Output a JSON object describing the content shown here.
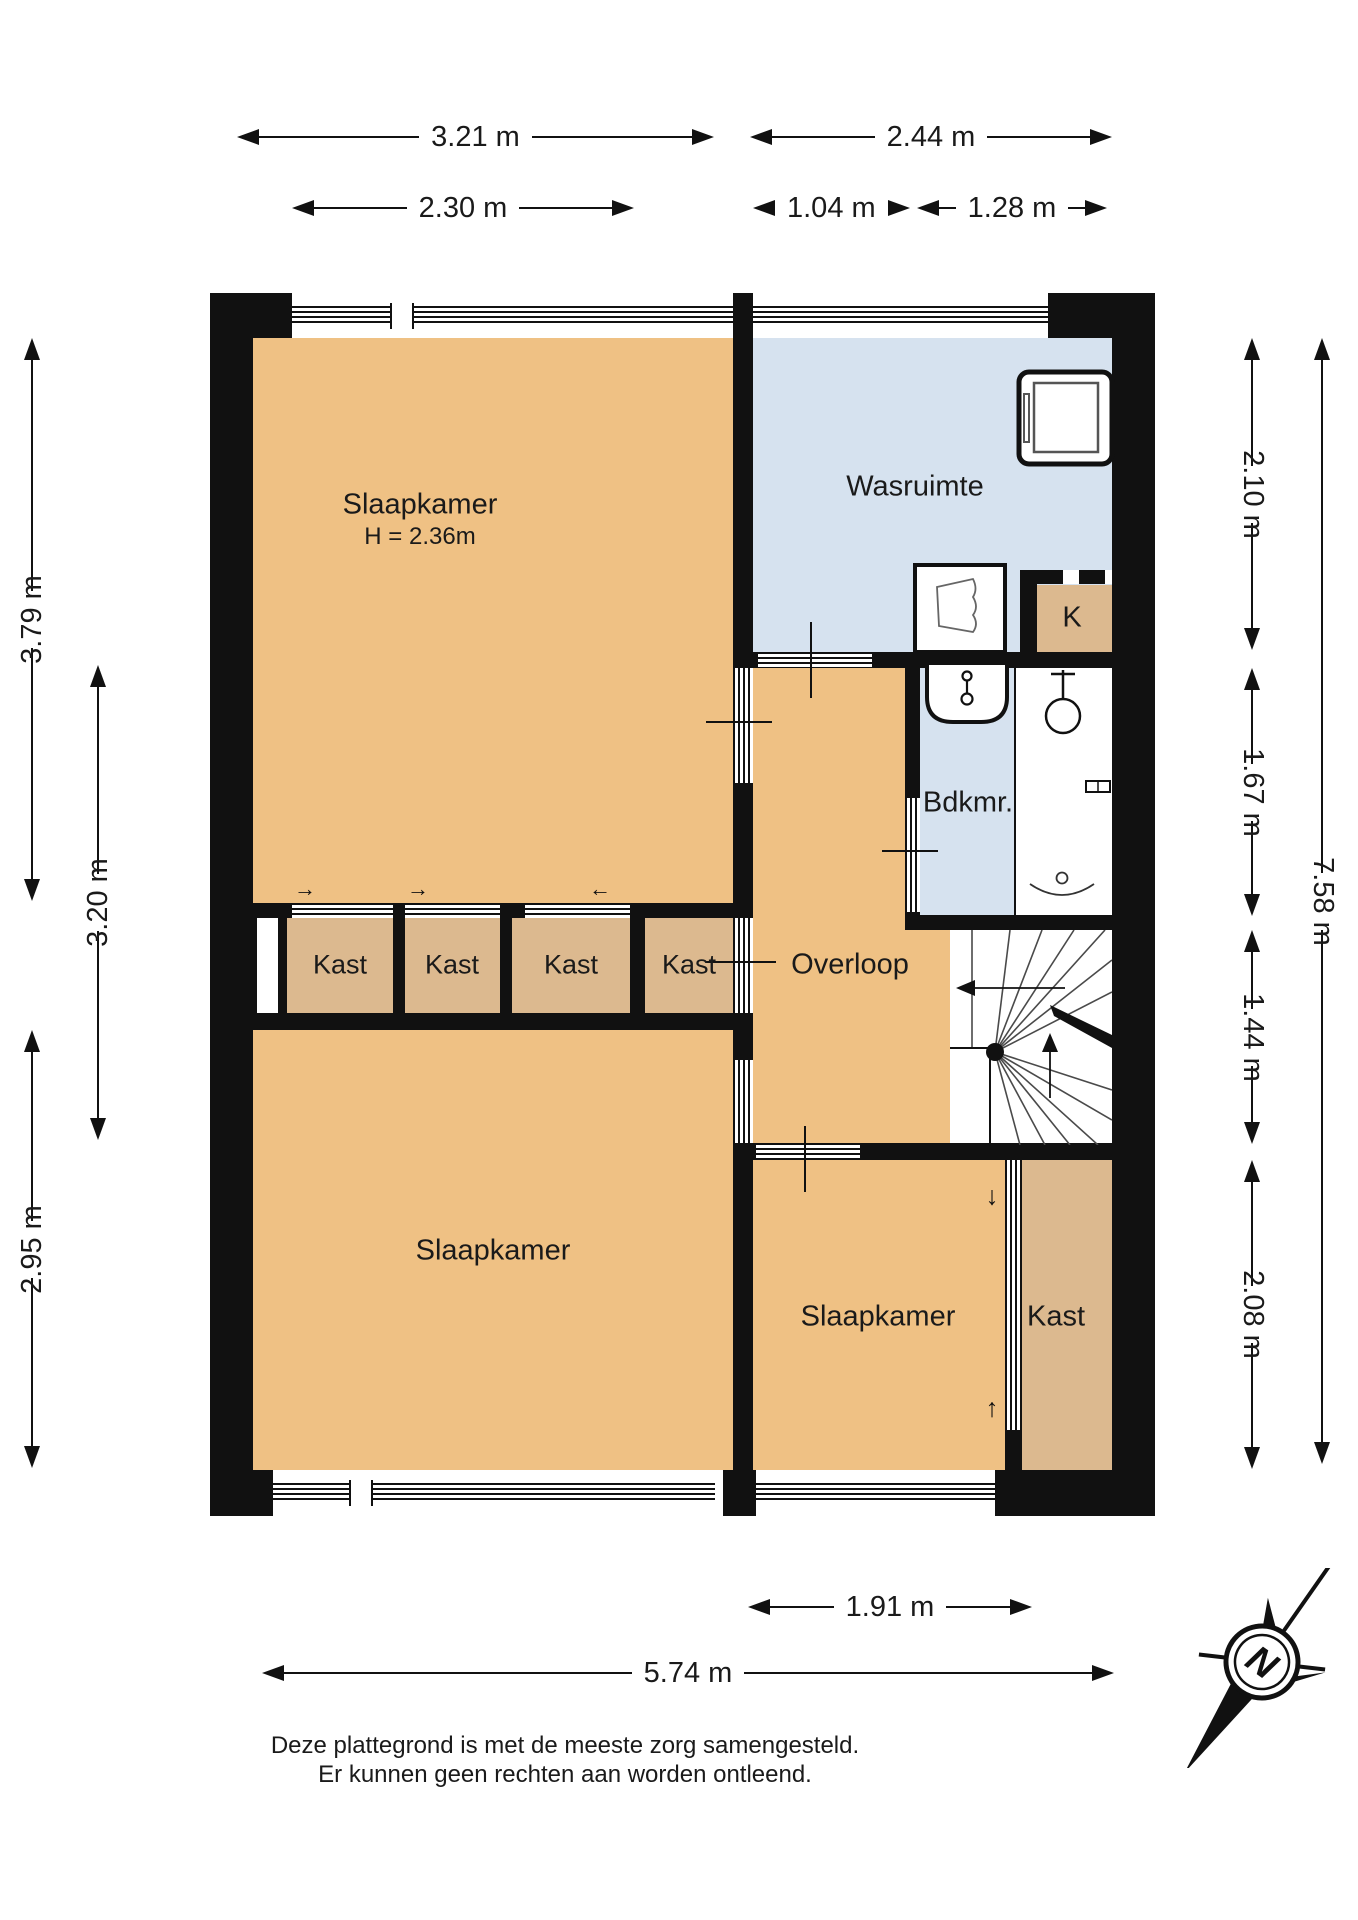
{
  "rooms": {
    "slaapkamer_tl": {
      "name": "Slaapkamer",
      "height_note": "H = 2.36m"
    },
    "wasruimte": {
      "name": "Wasruimte"
    },
    "k_closet": {
      "name": "K"
    },
    "badkamer": {
      "name": "Bdkmr."
    },
    "overloop": {
      "name": "Overloop"
    },
    "kast_row": [
      "Kast",
      "Kast",
      "Kast",
      "Kast"
    ],
    "slaapkamer_bl": {
      "name": "Slaapkamer"
    },
    "slaapkamer_br": {
      "name": "Slaapkamer"
    },
    "kast_br": {
      "name": "Kast"
    }
  },
  "dims": {
    "top_slaapkamer_width": "3.21 m",
    "top_wasruimte_width": "2.44 m",
    "top_window_width": "2.30 m",
    "top_left_segment": "1.04 m",
    "top_right_segment": "1.28 m",
    "left_slaapkamer_top_depth": "3.79 m",
    "left_inner_depth": "3.20 m",
    "left_slaapkamer_bottom_depth": "2.95 m",
    "right_wasruimte_depth": "2.10 m",
    "right_badkamer_depth": "1.67 m",
    "right_overloop_depth": "1.44 m",
    "right_slaapkamer_depth": "2.08 m",
    "right_total_depth": "7.58 m",
    "bottom_slaapkamer_width": "1.91 m",
    "bottom_total_width": "5.74 m"
  },
  "glyphs": {
    "door_arrow_right": "→",
    "door_arrow_left": "←",
    "door_arrow_up": "↑",
    "door_arrow_down": "↓"
  },
  "compass": {
    "north_label": "N"
  },
  "disclaimer": {
    "line1": "Deze plattegrond is met de meeste zorg samengesteld.",
    "line2": "Er kunnen geen rechten aan worden ontleend."
  },
  "colors": {
    "room_fill": "#efc184",
    "closet_fill": "#dcb98f",
    "wet_room_fill": "#d6e2ef",
    "wall": "#111111"
  }
}
